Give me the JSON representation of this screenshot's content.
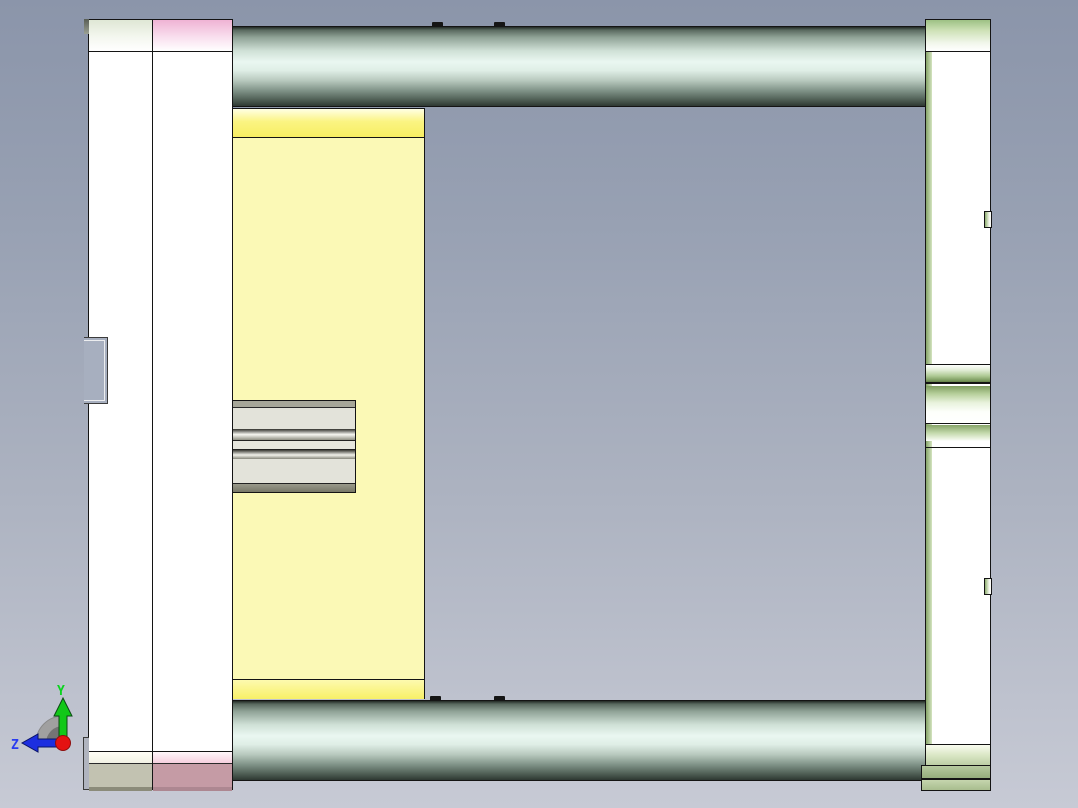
{
  "viewport": {
    "type": "cad-3d-viewport",
    "view_orientation": "side view",
    "background_top": "#8b95aa",
    "background_bottom": "#c7cad5"
  },
  "axis_triad": {
    "y_label": "Y",
    "z_label": "Z",
    "y_axis_color": "#12c818",
    "z_axis_color": "#1c2ee0",
    "origin_color": "#e41212",
    "fan_color": "#a0a0a0"
  },
  "model": {
    "description": "mold-base style assembly, side elevation",
    "palette": {
      "plate_white": "#ffffff",
      "guide_cylinder_teal": "#eaf7f1",
      "cavity_block_yellow": "#fbf9b6",
      "top_strip_pink": "#efb3d4",
      "bottom_block_mauve": "#c59ba5",
      "bottom_block_beige": "#c2c2b1",
      "right_plate_green": "#9dc184",
      "laminated_insert_gray": "#e3e3da",
      "outline": "#141414"
    }
  }
}
